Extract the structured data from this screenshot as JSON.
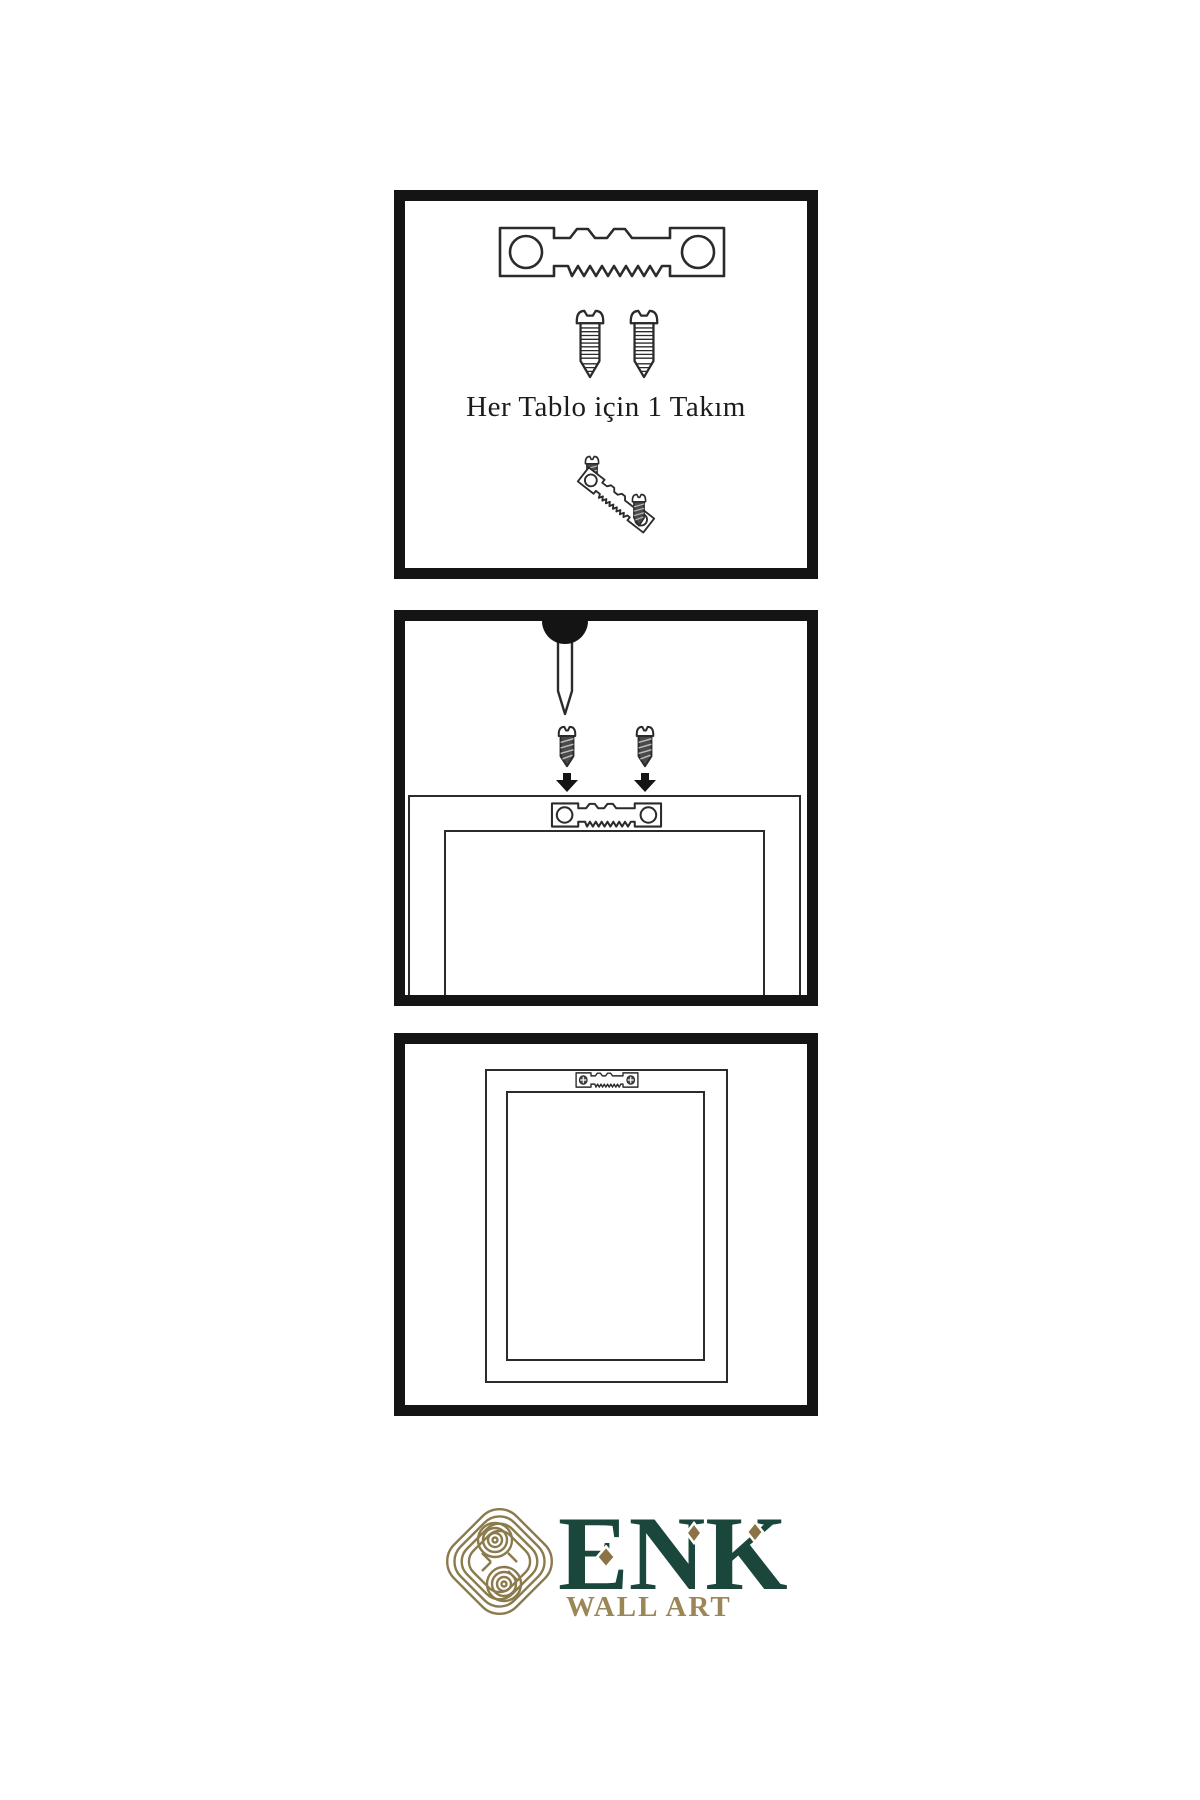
{
  "canvas": {
    "width": 1200,
    "height": 1800,
    "background": "#ffffff"
  },
  "colors": {
    "panel_border": "#141414",
    "line_art": "#2b2b2b",
    "screw_body_dark": "#4a4a4a",
    "logo_green": "#1b463b",
    "logo_gold": "#8a7a4c",
    "logo_gold_text": "#9b8655",
    "diamond_gold": "#8a7344"
  },
  "panel1": {
    "name": "hardware-kit-panel",
    "caption": "Her Tablo için 1 Takım",
    "icons": [
      "sawtooth-hanger-icon",
      "machine-screw-icon",
      "machine-screw-icon",
      "wood-screw-icon",
      "tilted-sawtooth-hanger-icon",
      "wood-screw-icon"
    ]
  },
  "panel2": {
    "name": "mounting-instructions-panel",
    "icons": [
      "nail-icon",
      "wood-screw-icon",
      "wood-screw-icon",
      "down-arrow-icon",
      "down-arrow-icon",
      "frame-back-outline",
      "sawtooth-hanger-icon"
    ]
  },
  "panel3": {
    "name": "mounted-frame-panel",
    "icons": [
      "frame-back-outline",
      "sawtooth-hanger-with-screws-icon"
    ]
  },
  "logo": {
    "brand": "ENK",
    "subtitle": "WALL ART",
    "icon": "knot-logo-icon"
  }
}
